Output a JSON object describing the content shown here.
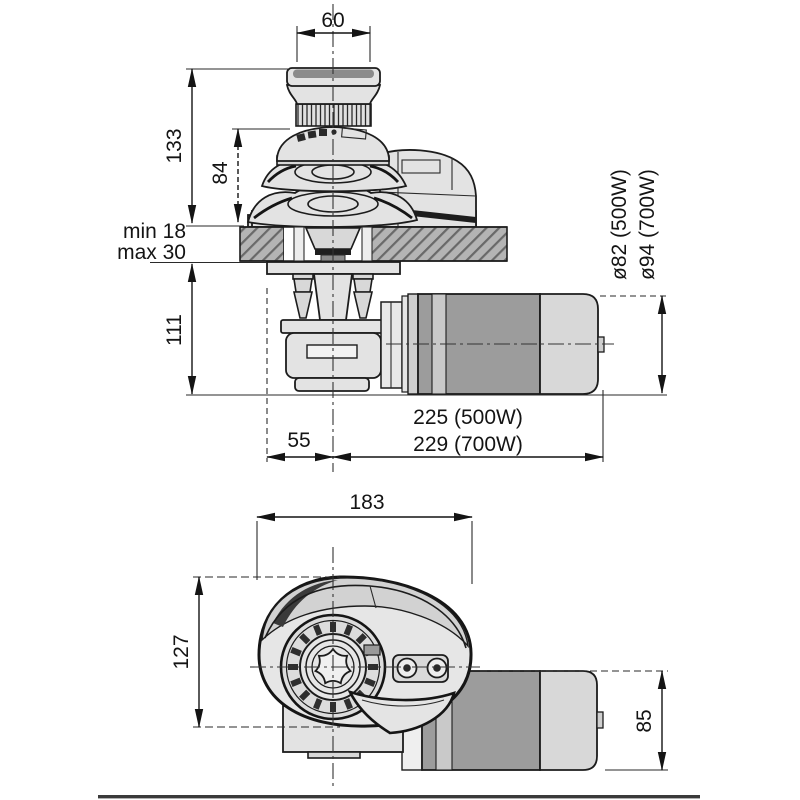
{
  "document": {
    "title": "Windlass dimensional drawing",
    "type": "technical-drawing",
    "units_note": ""
  },
  "colors": {
    "background": "#ffffff",
    "line": "#141414",
    "part_fill": "#e3e3e3",
    "deck_fill": "#b4b4b4",
    "motor_dark": "#9c9c9c",
    "motor_light": "#d8d8d8",
    "border_line": "#3a3a3a"
  },
  "side_view": {
    "name": "side elevation above and below deck",
    "dims": {
      "drum_width": "60",
      "overall_height": "133",
      "gypsy_height": "84",
      "deck_min": "min 18",
      "deck_max": "max 30",
      "below_deck_height": "111",
      "center_offset": "55",
      "length_500w": "225 (500W)",
      "length_700w": "229 (700W)",
      "motor_dia_500w": "ø82 (500W)",
      "motor_dia_700w": "ø94 (700W)"
    }
  },
  "front_view": {
    "name": "front elevation",
    "dims": {
      "overall_width": "183",
      "overall_height": "127",
      "motor_height": "85"
    }
  }
}
